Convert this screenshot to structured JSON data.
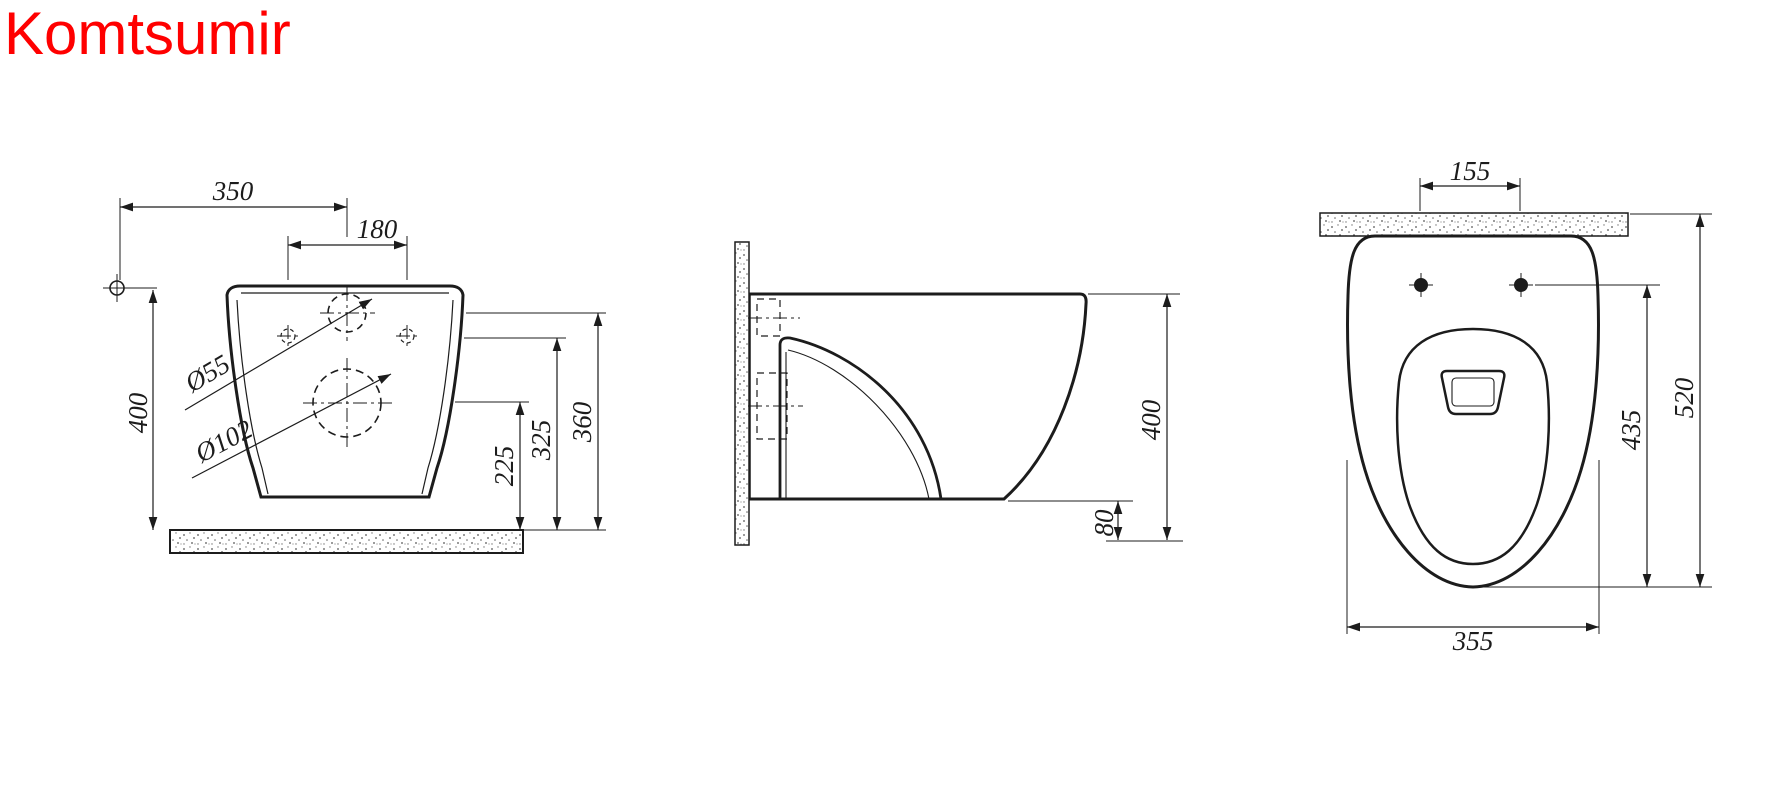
{
  "brand": {
    "name": "Komtsumir"
  },
  "colors": {
    "brand": "#ff0000",
    "line": "#1c1c1c"
  },
  "front_view": {
    "dim_offset": "350",
    "dim_hole_spacing": "180",
    "dim_height": "400",
    "label_inlet_diameter": "Ø55",
    "label_outlet_diameter": "Ø102",
    "dim_outlet_height": "225",
    "dim_fixing_height": "325",
    "dim_inlet_height": "360"
  },
  "side_view": {
    "dim_height": "400",
    "dim_floor_gap": "80"
  },
  "top_view": {
    "dim_bolt_spacing": "155",
    "dim_seat_depth": "435",
    "dim_total_depth": "520",
    "dim_width": "355"
  }
}
